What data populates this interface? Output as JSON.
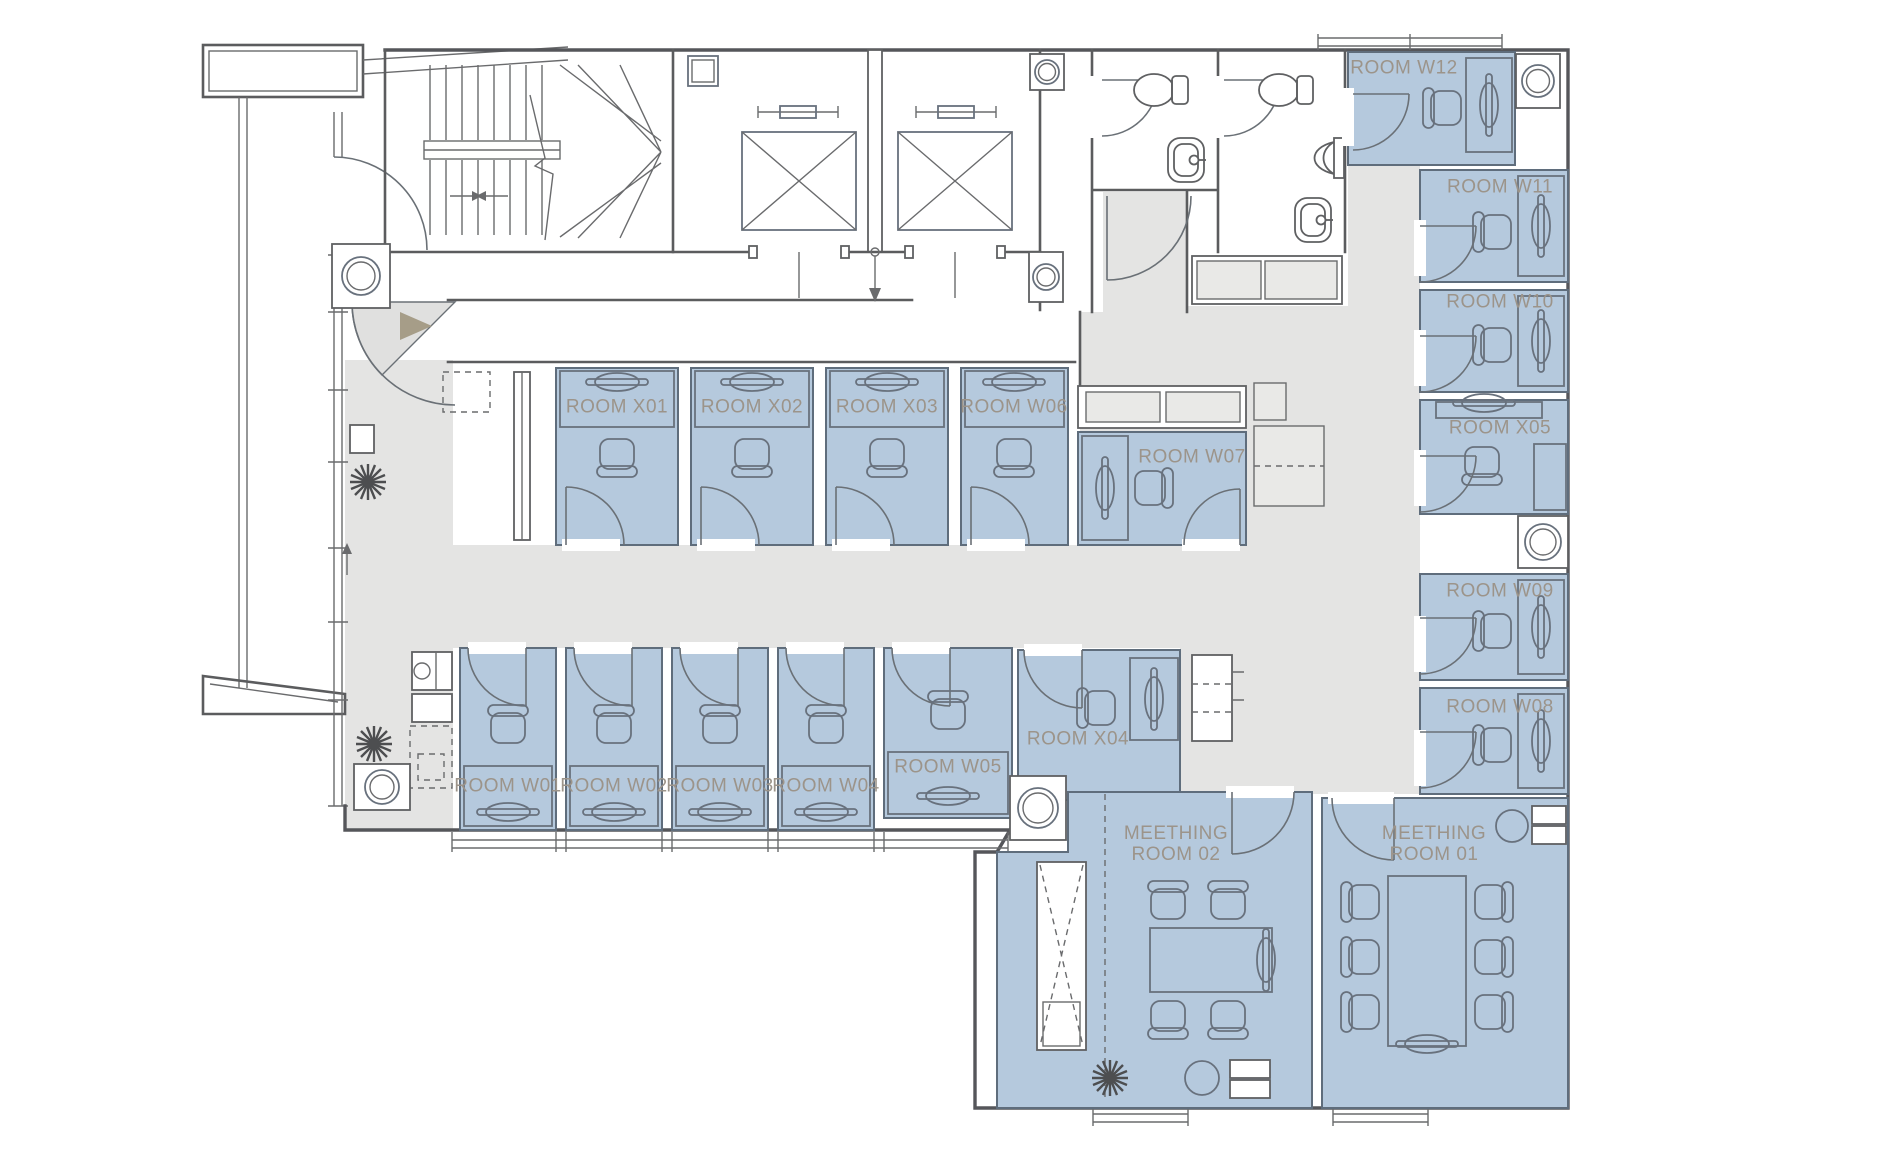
{
  "title": "Office floor plan",
  "colors": {
    "room_fill": "#b5c9dd",
    "corridor_fill": "#e4e4e3",
    "wall_line": "#5b5c5e",
    "label_text": "#9c948a",
    "entry_arrow": "#a69d88"
  },
  "rooms": {
    "x01": {
      "label": "ROOM X01"
    },
    "x02": {
      "label": "ROOM X02"
    },
    "x03": {
      "label": "ROOM X03"
    },
    "x04": {
      "label": "ROOM X04"
    },
    "x05": {
      "label": "ROOM X05"
    },
    "w01": {
      "label": "ROOM W01"
    },
    "w02": {
      "label": "ROOM W02"
    },
    "w03": {
      "label": "ROOM W03"
    },
    "w04": {
      "label": "ROOM W04"
    },
    "w05": {
      "label": "ROOM W05"
    },
    "w06": {
      "label": "ROOM W06"
    },
    "w07": {
      "label": "ROOM W07"
    },
    "w08": {
      "label": "ROOM W08"
    },
    "w09": {
      "label": "ROOM W09"
    },
    "w10": {
      "label": "ROOM W10"
    },
    "w11": {
      "label": "ROOM W11"
    },
    "w12": {
      "label": "ROOM W12"
    },
    "meeting01": {
      "label": "MEETHING\nROOM 01"
    },
    "meeting02": {
      "label": "MEETHING\nROOM 02"
    }
  }
}
